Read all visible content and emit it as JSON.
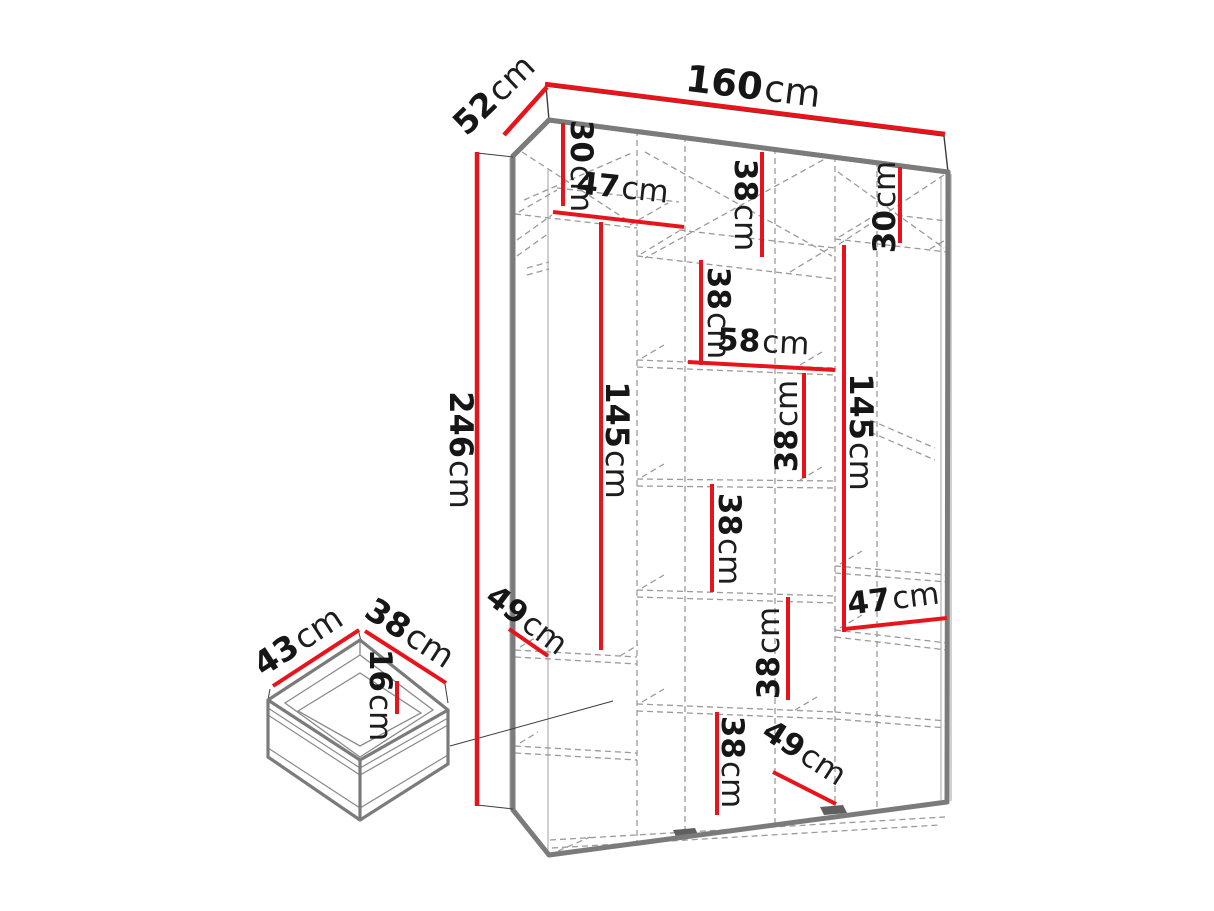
{
  "diagram_type": "furniture-dimension-diagram",
  "subject": "three-door wardrobe with interior shelving and drawer detail",
  "colors": {
    "dimension_red": "#e8141c",
    "outline_gray": "#7b7b7b",
    "dashed_gray": "#9a9a9a",
    "text_black": "#161616",
    "background": "#ffffff"
  },
  "overall": {
    "width": "160",
    "depth": "52",
    "height": "246",
    "unit": "cm"
  },
  "drawer_detail": {
    "width": "43",
    "depth": "38",
    "height": "16",
    "unit": "cm"
  },
  "labels": [
    {
      "name": "depth-top",
      "v": "52",
      "u": "cm"
    },
    {
      "name": "width-top",
      "v": "160",
      "u": "cm"
    },
    {
      "name": "left-top-gap",
      "v": "30",
      "u": "cm"
    },
    {
      "name": "left-shelf-width",
      "v": "47",
      "u": "cm"
    },
    {
      "name": "mid-cubby-1",
      "v": "38",
      "u": "cm"
    },
    {
      "name": "right-top-gap",
      "v": "30",
      "u": "cm"
    },
    {
      "name": "mid-cubby-2",
      "v": "38",
      "u": "cm"
    },
    {
      "name": "mid-shelf-width",
      "v": "58",
      "u": "cm"
    },
    {
      "name": "mid-cubby-3",
      "v": "38",
      "u": "cm"
    },
    {
      "name": "left-hanging-height",
      "v": "145",
      "u": "cm"
    },
    {
      "name": "right-hanging-height",
      "v": "145",
      "u": "cm"
    },
    {
      "name": "mid-cubby-4",
      "v": "38",
      "u": "cm"
    },
    {
      "name": "right-shelf-width",
      "v": "47",
      "u": "cm"
    },
    {
      "name": "left-shelf-depth",
      "v": "49",
      "u": "cm"
    },
    {
      "name": "mid-cubby-5",
      "v": "38",
      "u": "cm"
    },
    {
      "name": "mid-cubby-6",
      "v": "38",
      "u": "cm"
    },
    {
      "name": "bottom-shelf-depth",
      "v": "49",
      "u": "cm"
    },
    {
      "name": "total-height",
      "v": "246",
      "u": "cm"
    },
    {
      "name": "drawer-width",
      "v": "43",
      "u": "cm"
    },
    {
      "name": "drawer-depth",
      "v": "38",
      "u": "cm"
    },
    {
      "name": "drawer-height",
      "v": "16",
      "u": "cm"
    }
  ]
}
